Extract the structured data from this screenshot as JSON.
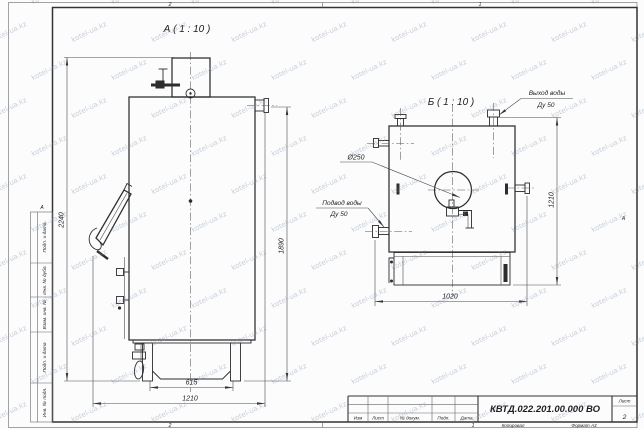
{
  "watermark": {
    "text": "kotel-ua.kz"
  },
  "sheet": {
    "zone_top_left": "2",
    "zone_top_right": "1",
    "zone_bottom_left": "2",
    "zone_bottom_right": "1",
    "zone_side_left": "А",
    "zone_side_right": "А",
    "copied_label": "Копировал",
    "format_label": "Формат А3"
  },
  "side_strip": {
    "cells": [
      "Подп. и дата",
      "Инв. № дубл.",
      "Взам. инв. №",
      "Подп. и дата",
      "Инв. № подл."
    ]
  },
  "title_block": {
    "designation": "КВТД.022.201.00.000 ВО",
    "columns": [
      "Изм",
      "Лист",
      "№ докум.",
      "Подп.",
      "Дата"
    ],
    "sheet_label": "Лист",
    "sheet_number": "2"
  },
  "views": {
    "a": {
      "title": "А ( 1 : 10 )",
      "dims": {
        "height_total": "2240",
        "height_right": "1890",
        "base_width": "615",
        "overall_width": "1210"
      }
    },
    "b": {
      "title": "Б ( 1 : 10 )",
      "dims": {
        "width": "1020",
        "height": "1210",
        "diameter": "Ø250"
      },
      "labels": {
        "outlet_line1": "Выход воды",
        "outlet_line2": "Ду 50",
        "inlet_line1": "Подвод воды",
        "inlet_line2": "Ду 50"
      }
    }
  }
}
